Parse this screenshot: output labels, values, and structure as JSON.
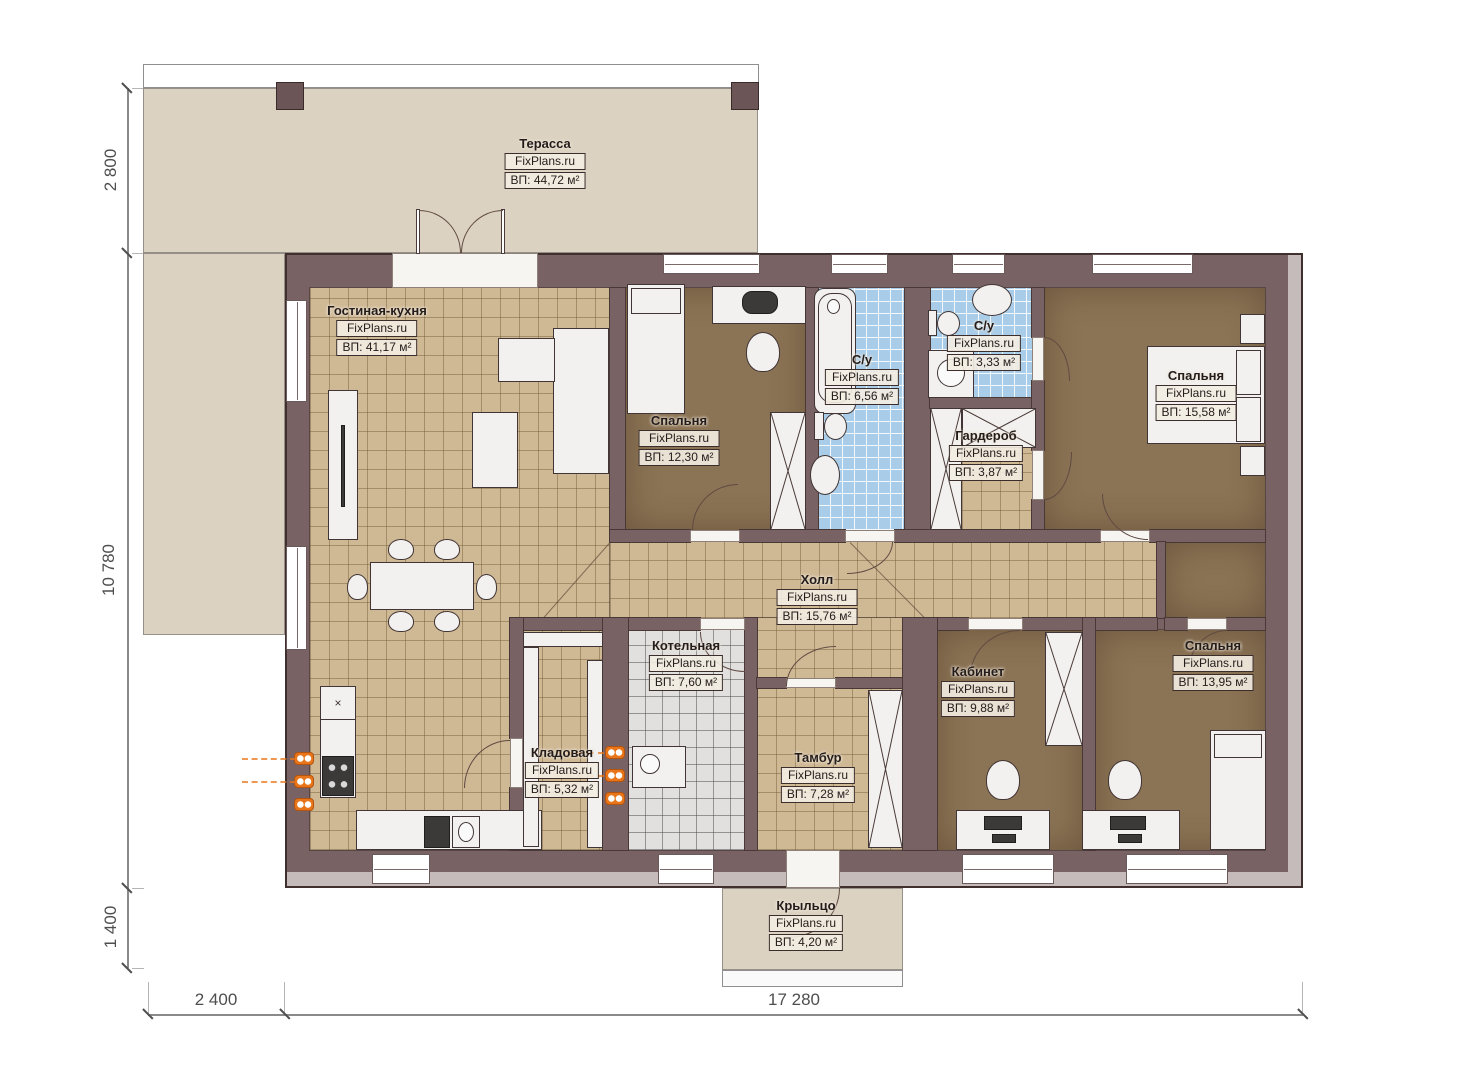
{
  "brand": "FixPlans.ru",
  "rooms": {
    "terrace": {
      "name": "Терасса",
      "area": "ВП: 44,72 м²"
    },
    "living": {
      "name": "Гостиная-кухня",
      "area": "ВП: 41,17 м²"
    },
    "bedroom1": {
      "name": "Спальня",
      "area": "ВП: 12,30 м²"
    },
    "bath1": {
      "name": "С/у",
      "area": "ВП: 6,56 м²"
    },
    "bath2": {
      "name": "С/у",
      "area": "ВП: 3,33 м²"
    },
    "wardrobe": {
      "name": "Гардероб",
      "area": "ВП: 3,87 м²"
    },
    "bedroom2": {
      "name": "Спальня",
      "area": "ВП: 15,58 м²"
    },
    "hall": {
      "name": "Холл",
      "area": "ВП: 15,76 м²"
    },
    "boiler": {
      "name": "Котельная",
      "area": "ВП: 7,60 м²"
    },
    "storage": {
      "name": "Кладовая",
      "area": "ВП: 5,32 м²"
    },
    "vestibule": {
      "name": "Тамбур",
      "area": "ВП: 7,28 м²"
    },
    "office": {
      "name": "Кабинет",
      "area": "ВП: 9,88 м²"
    },
    "bedroom3": {
      "name": "Спальня",
      "area": "ВП: 13,95 м²"
    },
    "porch": {
      "name": "Крыльцо",
      "area": "ВП: 4,20 м²"
    }
  },
  "dimensions": {
    "terrace_depth": "2 800",
    "house_height": "10 780",
    "porch_depth": "1 400",
    "terrace_width": "2 400",
    "house_width": "17 280"
  },
  "symbols": {
    "sink_cross": "×"
  },
  "colors": {
    "wall": "#786264",
    "terrace": "#dcd2c1",
    "tile_tan": "#cfb894",
    "floor_brown": "#8b7355",
    "tile_blue": "#a9cde9",
    "tile_gray": "#e1e0de",
    "radiator": "#e8751a"
  }
}
